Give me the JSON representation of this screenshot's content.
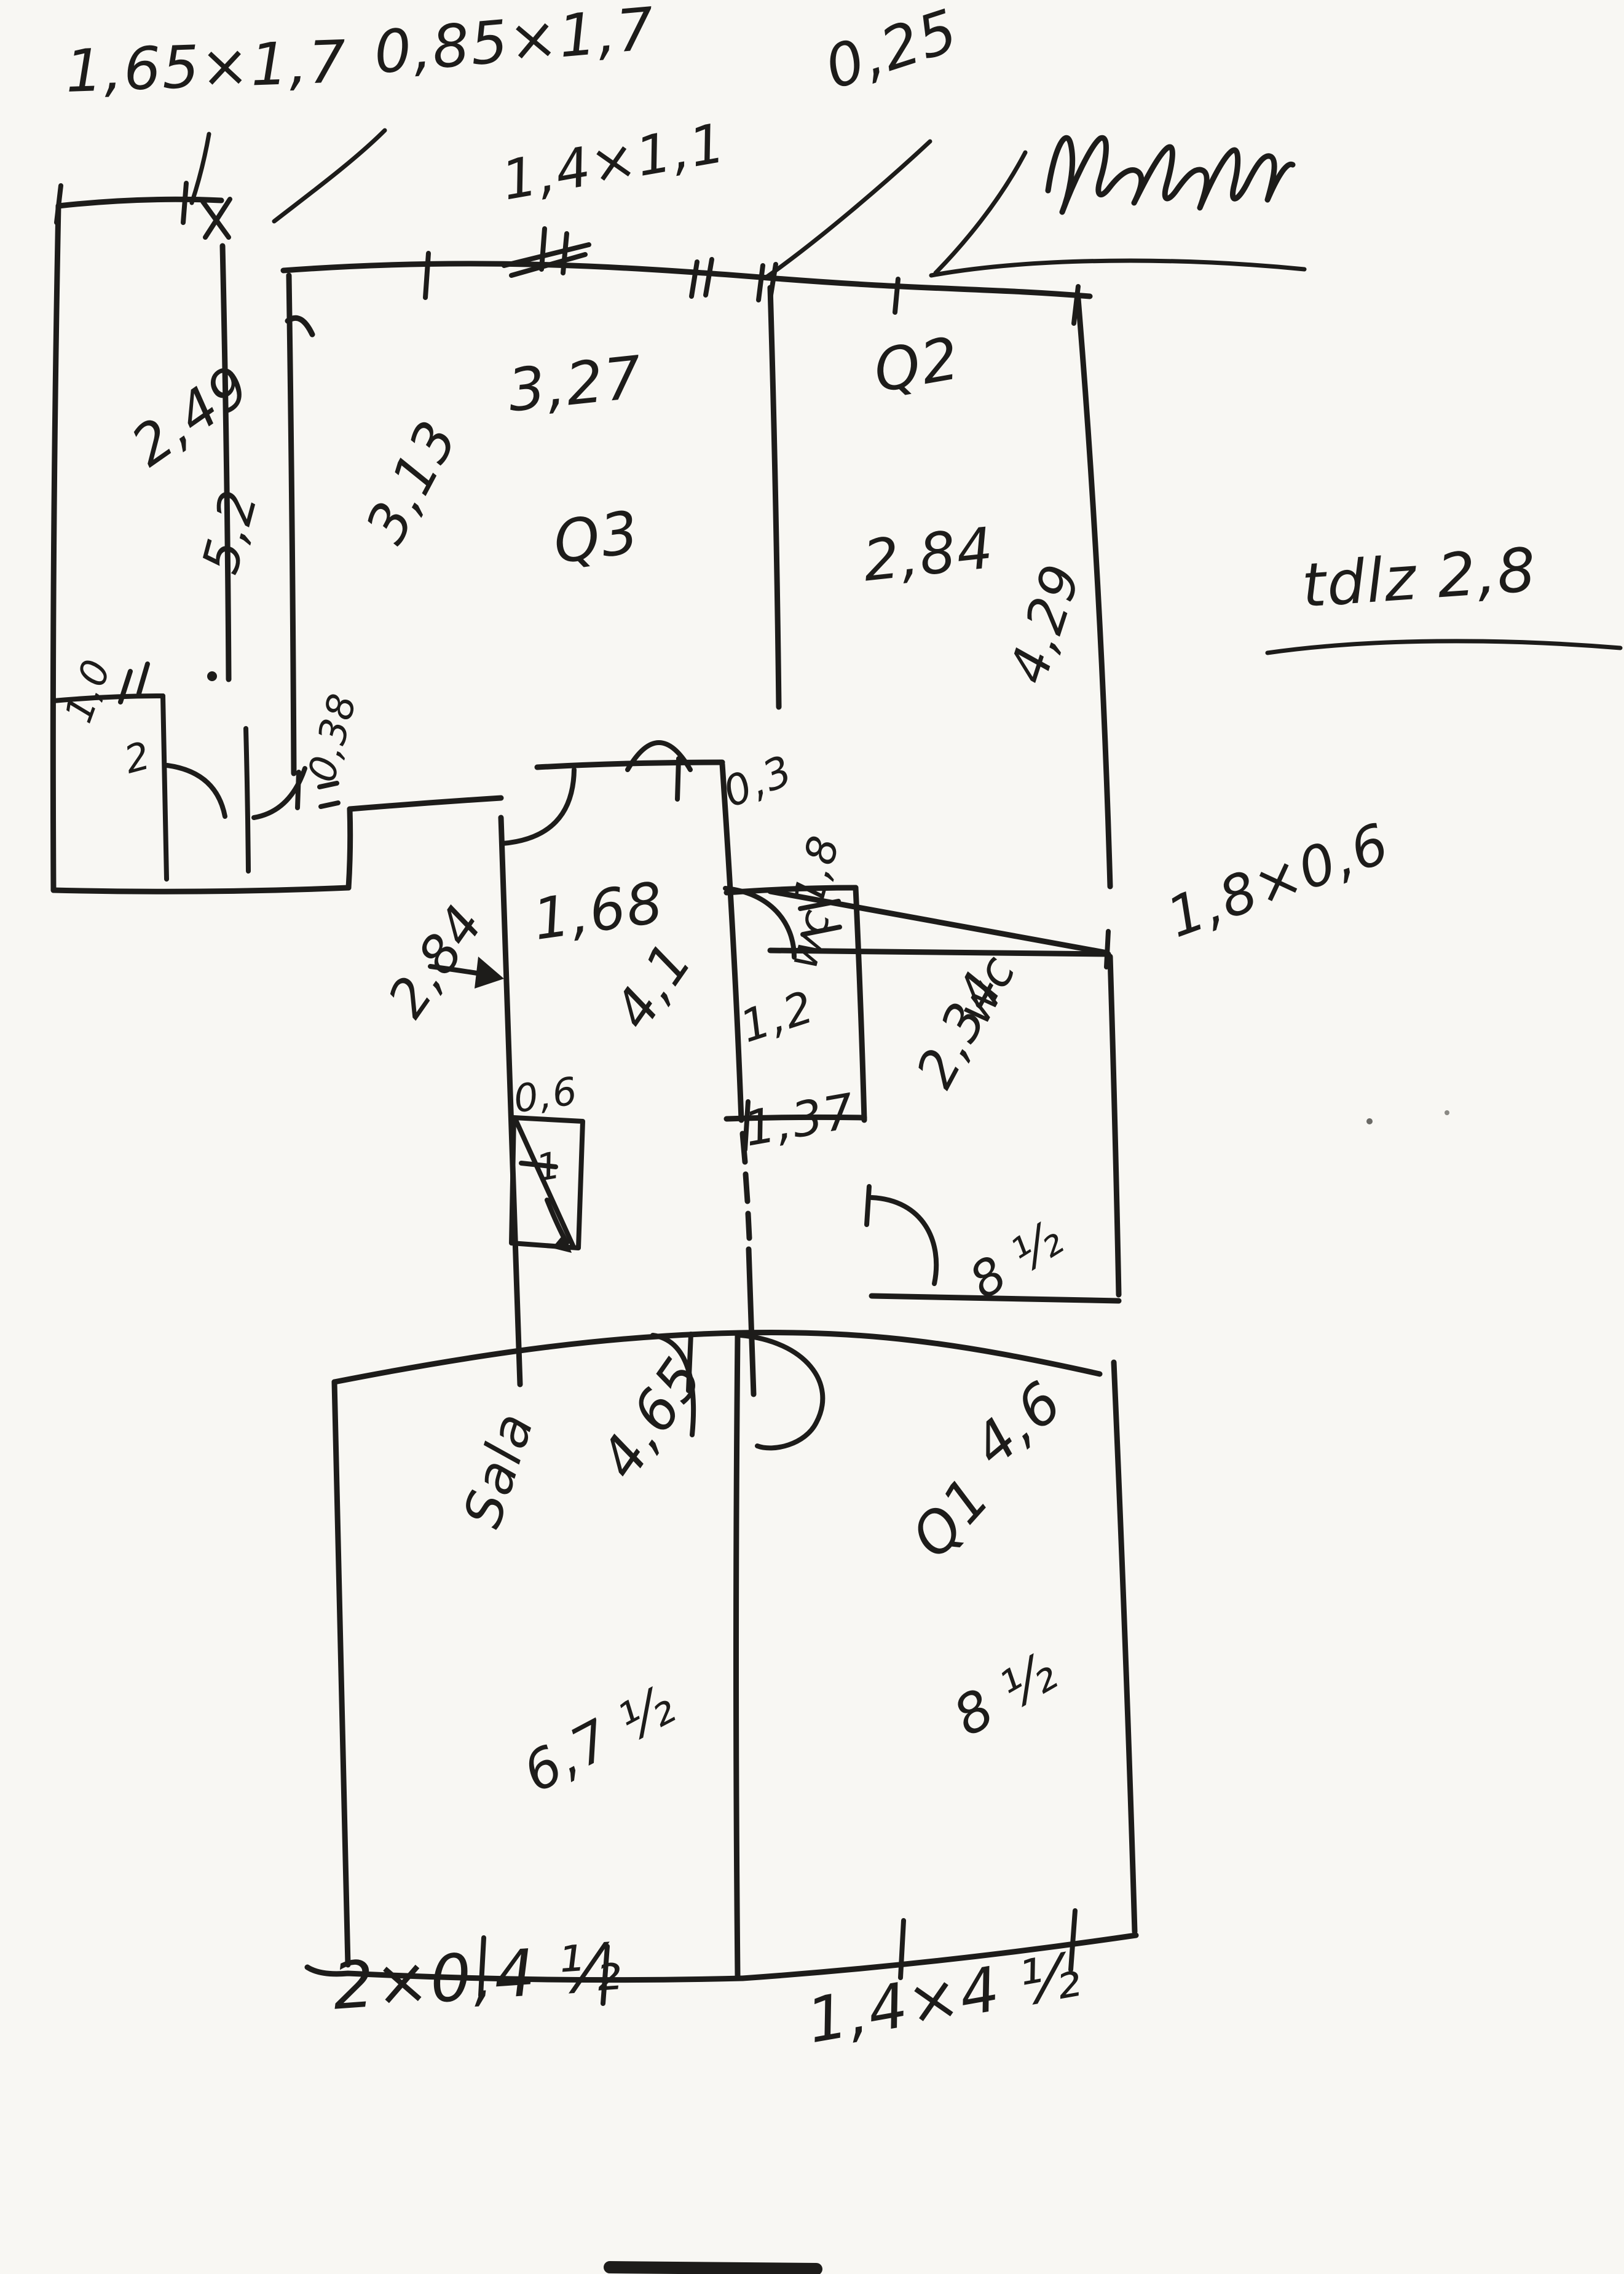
{
  "page": {
    "background": "#f8f7f3",
    "ink": "#1d1c1a"
  },
  "annotations": {
    "window_a": "1,65×1,7",
    "window_b": "0,85×1,7",
    "window_c": "1,4×1,1",
    "wall_thickness": "0,25",
    "scribble": "illegible-handwriting",
    "side_note": "tdlz 2,8"
  },
  "room_a": {
    "w": "2,49",
    "h": "5,2",
    "closet_w": "1,0",
    "closet_n": "2",
    "step": "0,38"
  },
  "room_q3": {
    "name": "Q3",
    "w": "3,27",
    "h": "3,13"
  },
  "room_q2": {
    "name": "Q2",
    "w": "2,84",
    "h": "4,29"
  },
  "hall": {
    "gap": "0,3",
    "w": "1,68",
    "h": "4,1",
    "outer": "2,84",
    "shaft_w": "0,6",
    "shaft_n": "1"
  },
  "wc_small": {
    "h": "1,8",
    "name": "wc",
    "w": "1,2",
    "d": "1,37"
  },
  "wc_big": {
    "name": "wc",
    "h": "2,34",
    "window": "1,8×0,6",
    "door": "8 ½"
  },
  "sala": {
    "name": "Sala",
    "diag": "4,65",
    "bottom": "6,7 ½"
  },
  "room_q1": {
    "name": "Q1",
    "diag": "4,6",
    "bottom": "8 ½"
  },
  "bottom_dims": {
    "left": "2×0,4 ½",
    "right": "1,4×4 ½"
  }
}
